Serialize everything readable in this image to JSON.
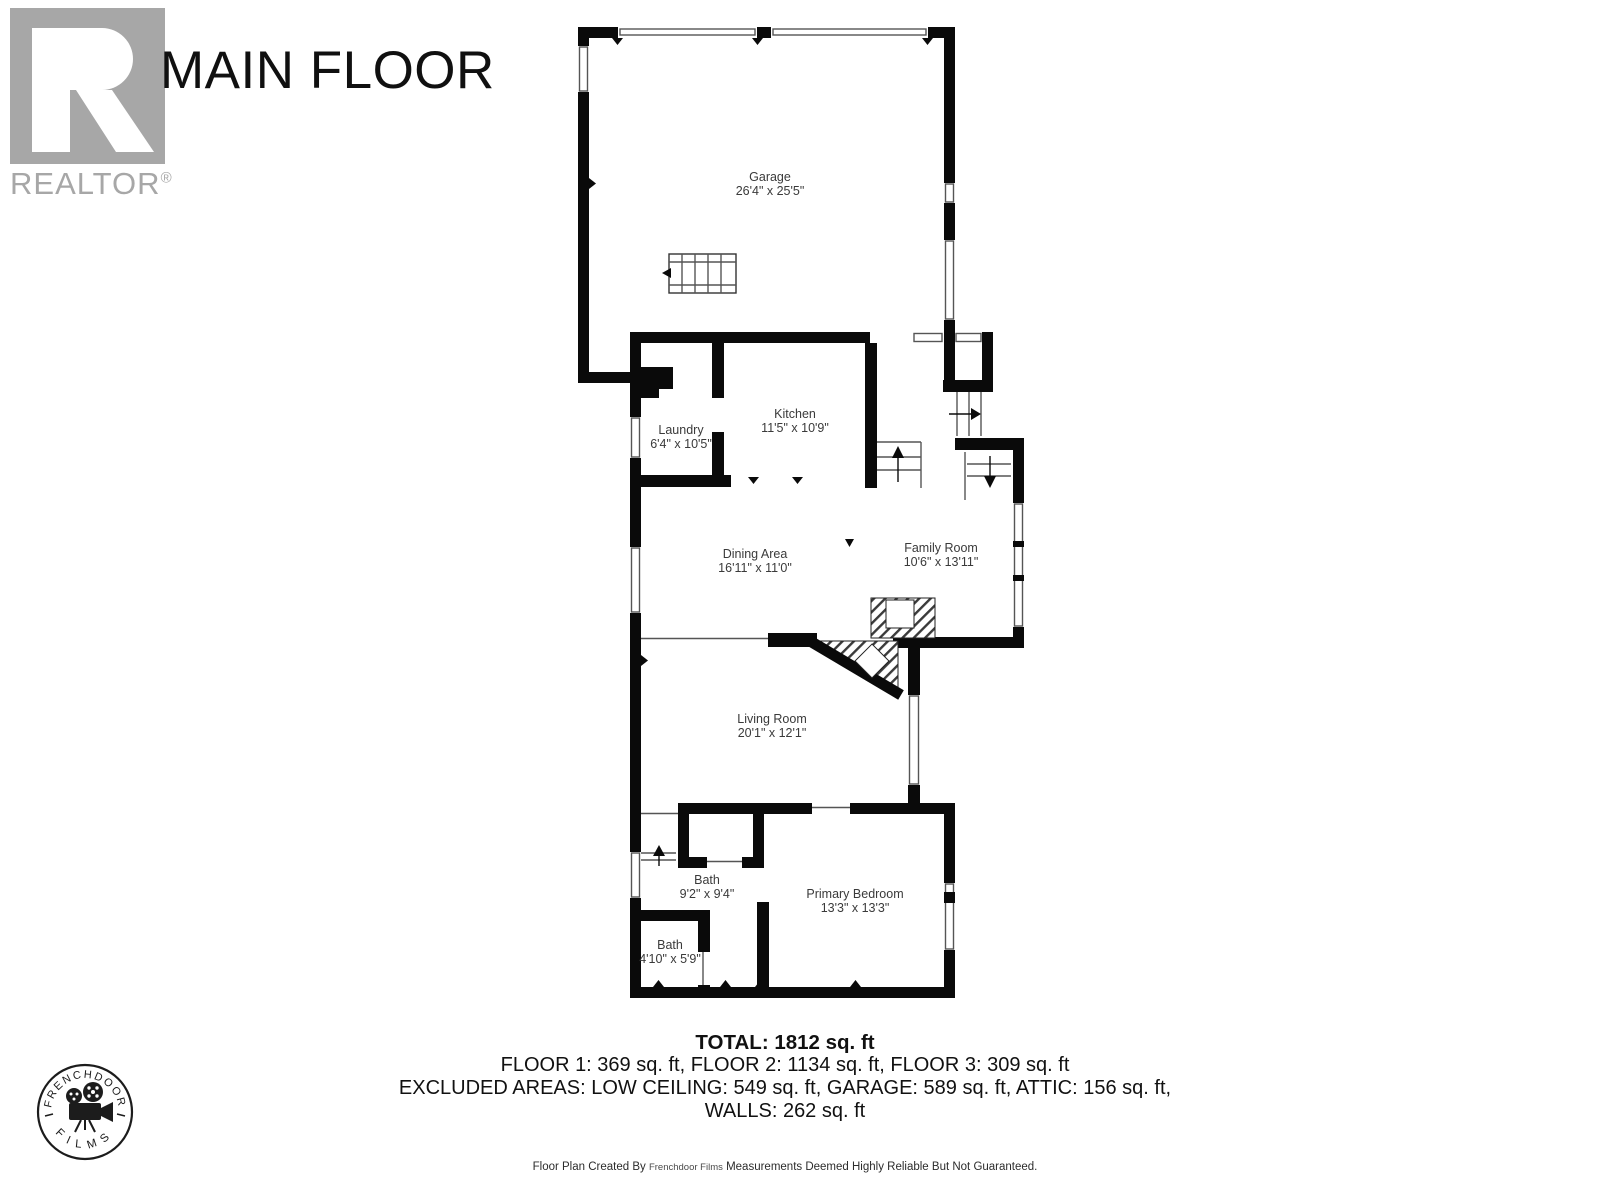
{
  "header": {
    "title": "MAIN FLOOR",
    "logo_text": "REALTOR",
    "registered": "®"
  },
  "rooms": [
    {
      "id": "garage",
      "name": "Garage",
      "dims": "26'4\" x 25'5\""
    },
    {
      "id": "laundry",
      "name": "Laundry",
      "dims": "6'4\" x 10'5\""
    },
    {
      "id": "kitchen",
      "name": "Kitchen",
      "dims": "11'5\" x 10'9\""
    },
    {
      "id": "dining",
      "name": "Dining Area",
      "dims": "16'11\" x 11'0\""
    },
    {
      "id": "family",
      "name": "Family Room",
      "dims": "10'6\" x 13'11\""
    },
    {
      "id": "living",
      "name": "Living Room",
      "dims": "20'1\" x 12'1\""
    },
    {
      "id": "bath1",
      "name": "Bath",
      "dims": "9'2\" x 9'4\""
    },
    {
      "id": "bath2",
      "name": "Bath",
      "dims": "4'10\" x 5'9\""
    },
    {
      "id": "primary",
      "name": "Primary Bedroom",
      "dims": "13'3\" x 13'3\""
    }
  ],
  "summary": {
    "total": "TOTAL: 1812 sq. ft",
    "floors": "FLOOR 1: 369 sq. ft, FLOOR 2: 1134 sq. ft, FLOOR 3: 309 sq. ft",
    "excluded": "EXCLUDED AREAS: LOW CEILING: 549 sq. ft, GARAGE: 589 sq. ft, ATTIC: 156 sq. ft,",
    "walls": "WALLS: 262 sq. ft"
  },
  "footer": {
    "created_by": "Floor Plan Created By",
    "company": "Frenchdoor Films",
    "disclaimer": "Measurements Deemed Highly Reliable But Not Guaranteed."
  },
  "stamp": {
    "top": "FRENCHDOOR",
    "bottom": "FILMS"
  },
  "colors": {
    "wall": "#0a0a0a",
    "thin_line": "#555555",
    "logo_gray": "#a7a7a7",
    "label_text": "#3a3a3a"
  }
}
